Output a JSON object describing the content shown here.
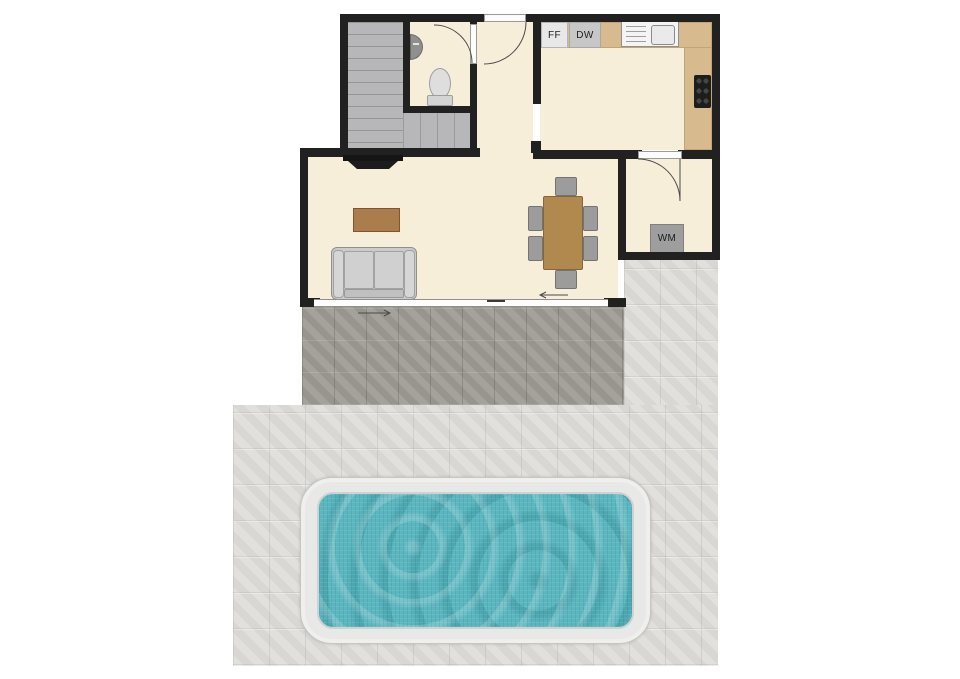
{
  "labels": {
    "ff": "FF",
    "dw": "DW",
    "wm": "WM"
  },
  "palette": {
    "wall": "#212121",
    "floor": "#f7eeda",
    "stairs": "#b7b7b9",
    "counter": "#d7bb8e",
    "patio_dark": "#a09d96",
    "patio_light": "#e0deda",
    "pool_water": "#5bb6c0",
    "pool_coping": "#e8e8e6",
    "wood_furniture": "#b1894f",
    "sofa": "#cbcbcb",
    "chair": "#9c9c9c"
  },
  "fixtures": [
    "staircase",
    "stair-landing",
    "wash-basin",
    "toilet",
    "front-door",
    "bathroom-door",
    "fridge-freezer",
    "dishwasher",
    "kitchen-sink",
    "hob",
    "kitchen-counter",
    "utility-door",
    "washing-machine",
    "tv",
    "coffee-table",
    "sofa",
    "dining-table",
    "dining-chairs",
    "sliding-patio-door",
    "patio-dark",
    "patio-light",
    "swimming-pool"
  ]
}
